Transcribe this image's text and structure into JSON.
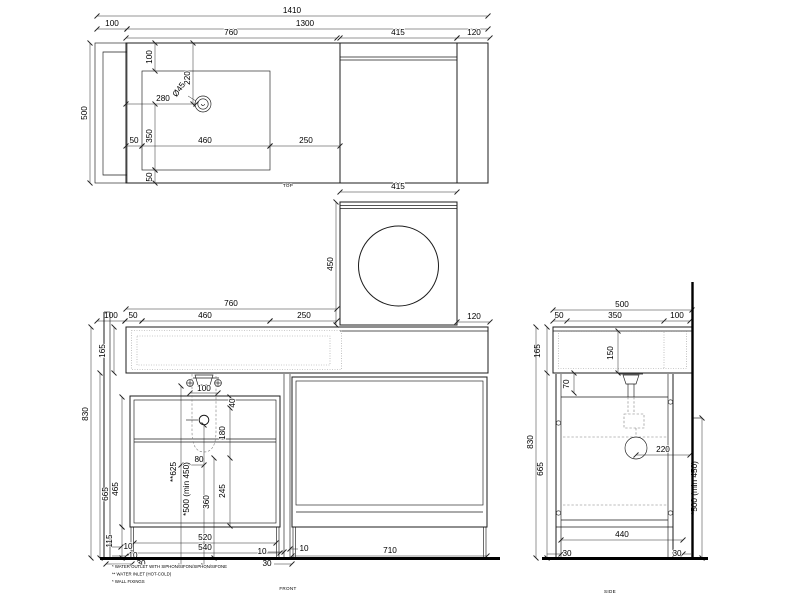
{
  "colors": {
    "line": "#1c1c1c",
    "background": "#ffffff"
  },
  "views": {
    "top": {
      "label": "TOP",
      "dims": {
        "overall_width": "1410",
        "body_width": "1300",
        "bracket_depth": "100",
        "left_section": "760",
        "washer_width": "415",
        "side_panel": "120",
        "counter_depth": "500",
        "sink_top_inset": "100",
        "hole_from_back": "220",
        "hole_diameter": "Ø45",
        "hole_from_left": "280",
        "sink_depth": "350",
        "sink_left_inset": "50",
        "sink_width": "460",
        "sink_to_washer": "250",
        "sink_bottom_inset": "50",
        "washer_width_lower": "415"
      }
    },
    "washer": {
      "dims": {
        "door_height": "450",
        "side_panel": "120"
      }
    },
    "front": {
      "label": "FRONT",
      "dims": {
        "left_section": "760",
        "wall_offset": "100",
        "sink_left_inset": "50",
        "sink_width": "460",
        "sink_to_washer": "250",
        "worktop_height": "165",
        "total_height": "830",
        "under_worktop": "665",
        "cabinet_height": "465",
        "leg_height": "115",
        "inlet_spacing": "100",
        "top_inset": "40",
        "upper_zone": "180",
        "inlet_outlet_gap": "80",
        "lower_zone": "245",
        "trap_height": "360",
        "inlet_height": "**625",
        "outlet_height": "*500 (min 450)",
        "door_width": "520",
        "cabinet_width": "540",
        "gap_a": "10",
        "gap_b": "10",
        "wall_gap": "30",
        "divider_gap_left": "10",
        "divider_width": "30",
        "divider_gap_right": "10",
        "right_door_width": "710"
      }
    },
    "side": {
      "label": "SIDE",
      "dims": {
        "depth": "500",
        "front_offset": "50",
        "drain_offset": "350",
        "back_gap": "100",
        "worktop_height": "165",
        "basin_depth": "150",
        "apron_height": "70",
        "total_height": "830",
        "under_worktop": "665",
        "siphon_offset": "220",
        "outlet_height": "*500 (min 450)",
        "base_width": "440",
        "front_leg": "30",
        "back_leg": "30"
      }
    }
  },
  "notes": {
    "outlet": "* WATER OUTLET WITH SIPHON/SIFON/SIPHON/SIFONE",
    "inlet": "** WATER INLET (HOT-COLD)",
    "fixings": "* WALL FIXINGS"
  }
}
